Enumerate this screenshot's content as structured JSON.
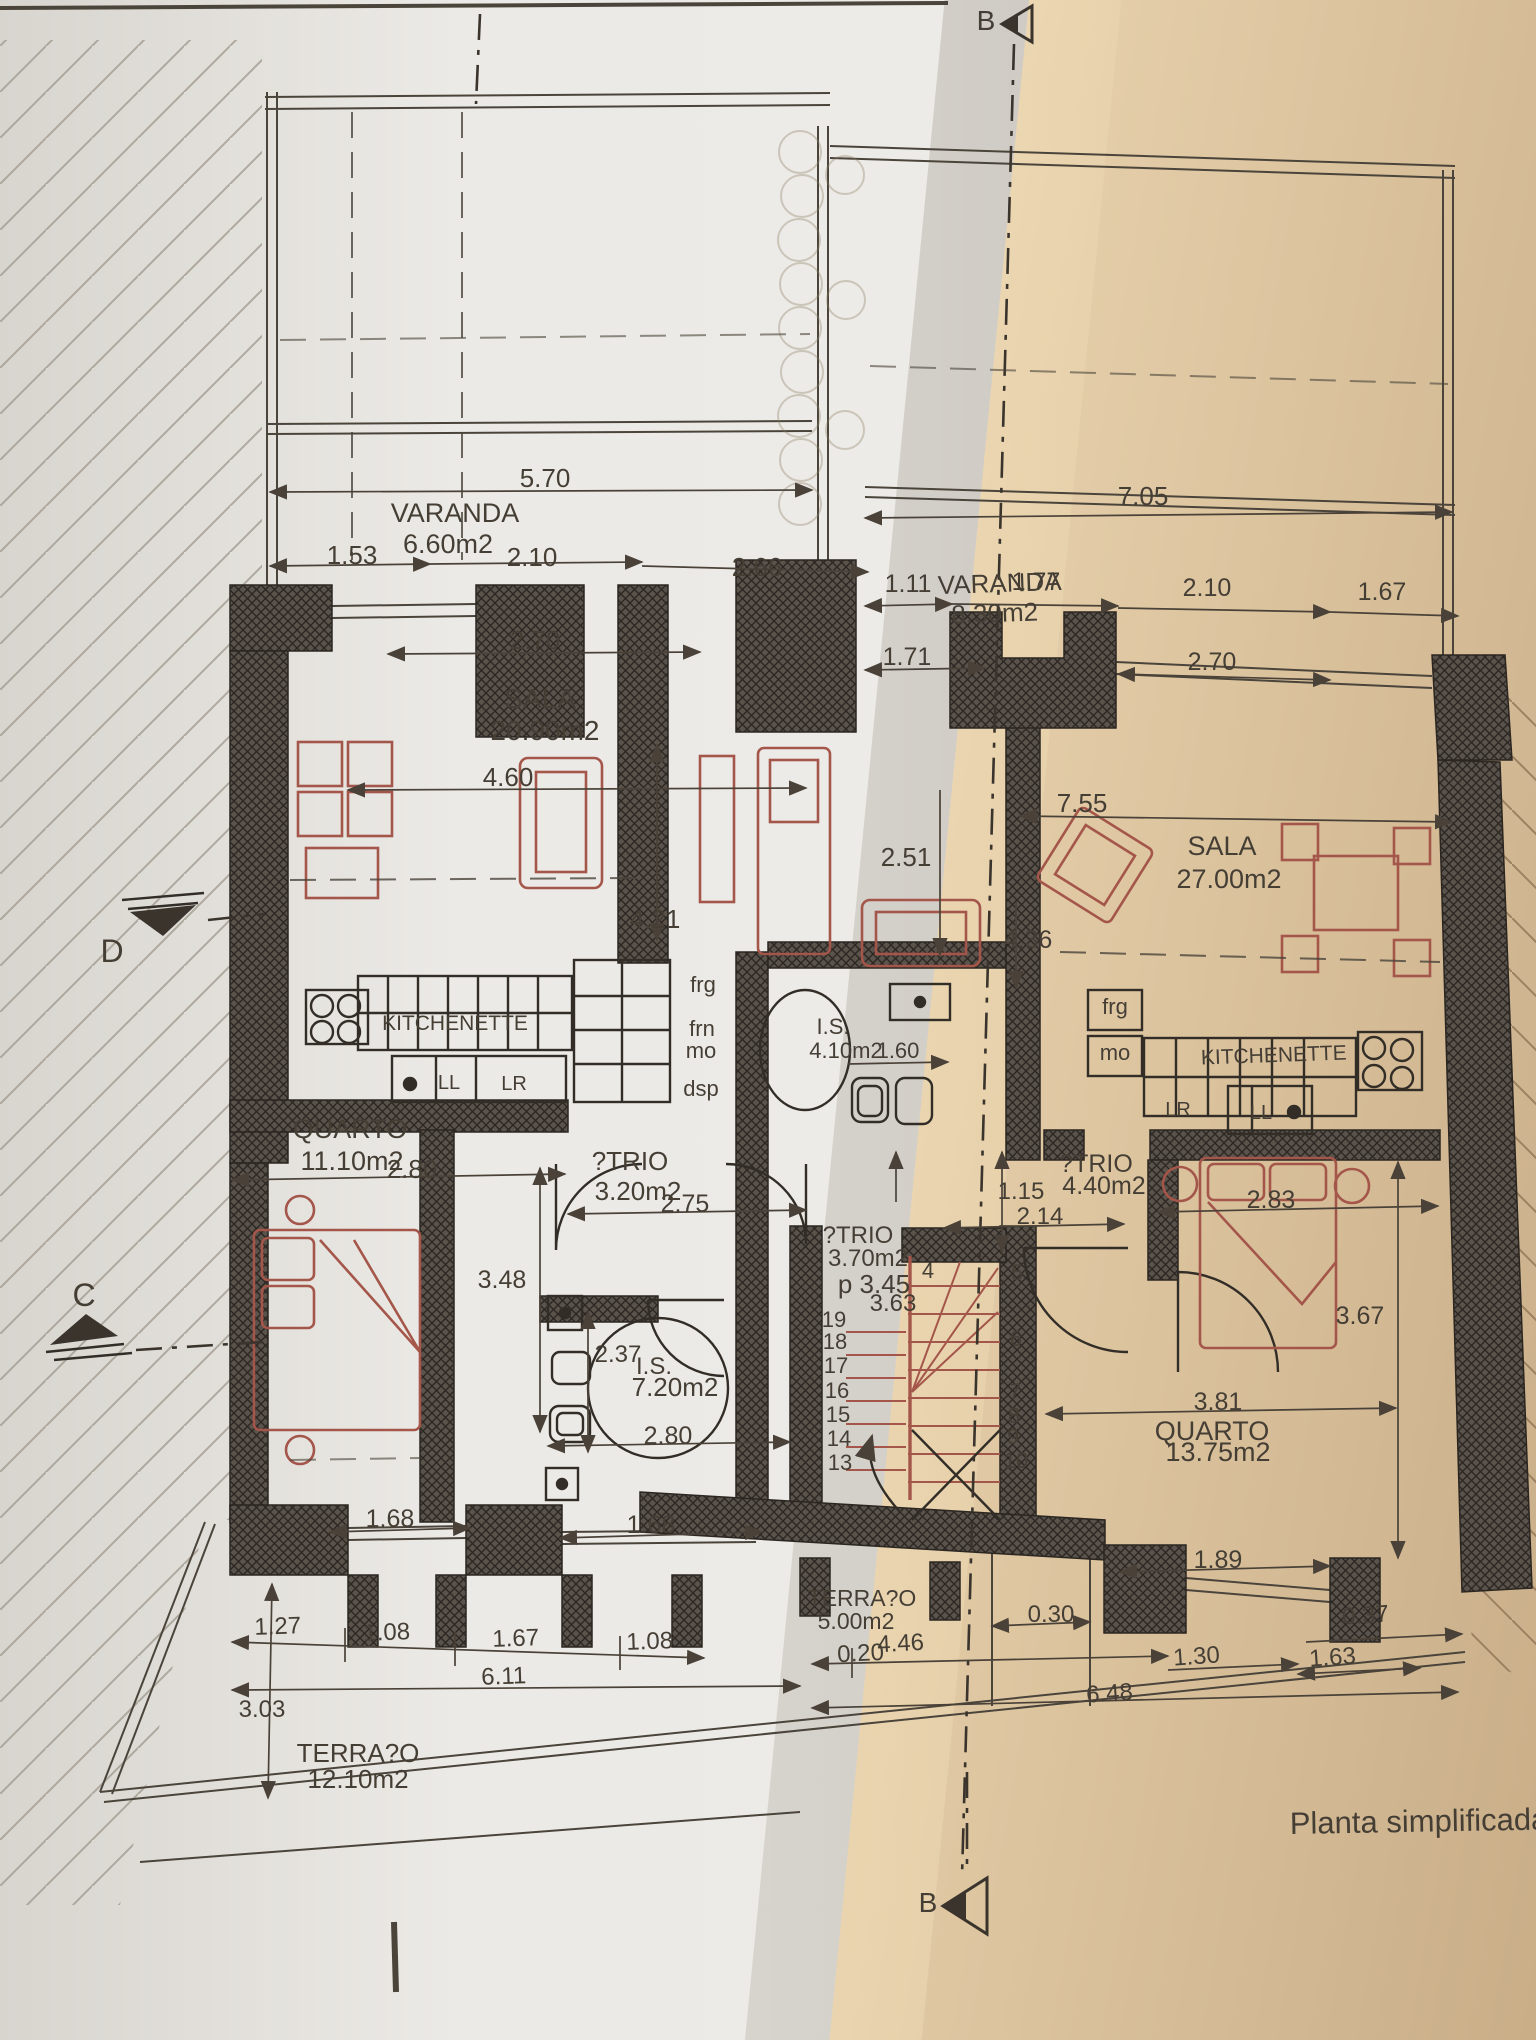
{
  "caption": "Planta simplificada d",
  "colors": {
    "paper_left": "#edebe7",
    "paper_right": "#e3cca7",
    "ink": "#453e35",
    "wall_fill": "#5a534b",
    "furniture_red": "#a4564a"
  },
  "section_markers": {
    "top": "B",
    "bottom": "B",
    "left_upper": "D",
    "left_lower": "C"
  },
  "rooms_note": "two-apartment floor plan, labels in texts[]",
  "plan": {
    "texts": [
      {
        "n": "varanda-left-label",
        "t": "VARANDA",
        "x": 455,
        "y": 522,
        "s": 27
      },
      {
        "n": "varanda-left-area",
        "t": "6.60m2",
        "x": 448,
        "y": 553,
        "s": 27
      },
      {
        "n": "dim-5-70",
        "t": "5.70",
        "x": 545,
        "y": 487,
        "s": 26
      },
      {
        "n": "dim-1-53",
        "t": "1.53",
        "x": 352,
        "y": 564,
        "s": 26
      },
      {
        "n": "dim-2-10-left",
        "t": "2.10",
        "x": 532,
        "y": 566,
        "s": 26
      },
      {
        "n": "dim-2-66",
        "t": "2.66",
        "x": 757,
        "y": 576,
        "s": 26
      },
      {
        "n": "dim-2-70-left",
        "t": "2.70",
        "x": 535,
        "y": 649,
        "s": 26
      },
      {
        "n": "dim-7-05",
        "t": "7.05",
        "x": 1143,
        "y": 505,
        "s": 26
      },
      {
        "n": "varanda-right-label",
        "t": "VARANDA",
        "x": 1000,
        "y": 592,
        "s": 26,
        "r": -2
      },
      {
        "n": "varanda-right-area",
        "t": "8.30m2",
        "x": 995,
        "y": 622,
        "s": 26,
        "r": -2
      },
      {
        "n": "dim-1-11",
        "t": "1.11",
        "x": 908,
        "y": 592,
        "s": 25
      },
      {
        "n": "dim-1-77",
        "t": "1.77",
        "x": 1036,
        "y": 590,
        "s": 25
      },
      {
        "n": "dim-2-10-right",
        "t": "2.10",
        "x": 1207,
        "y": 596,
        "s": 25
      },
      {
        "n": "dim-1-67-right",
        "t": "1.67",
        "x": 1382,
        "y": 600,
        "s": 25
      },
      {
        "n": "dim-1-71",
        "t": "1.71",
        "x": 907,
        "y": 665,
        "s": 25
      },
      {
        "n": "dim-2-70-right",
        "t": "2.70",
        "x": 1212,
        "y": 670,
        "s": 25
      },
      {
        "n": "sala-left-label",
        "t": "SALA",
        "x": 540,
        "y": 708,
        "s": 28
      },
      {
        "n": "sala-left-area",
        "t": "20.90m2",
        "x": 545,
        "y": 740,
        "s": 28
      },
      {
        "n": "dim-4-60",
        "t": "4.60",
        "x": 508,
        "y": 786,
        "s": 26
      },
      {
        "n": "dim-4-21",
        "t": "4.21",
        "x": 655,
        "y": 928,
        "s": 26
      },
      {
        "n": "dim-2-51",
        "t": "2.51",
        "x": 906,
        "y": 866,
        "s": 26
      },
      {
        "n": "dim-7-55",
        "t": "7.55",
        "x": 1082,
        "y": 812,
        "s": 26
      },
      {
        "n": "sala-right-label",
        "t": "SALA",
        "x": 1222,
        "y": 855,
        "s": 27
      },
      {
        "n": "sala-right-area",
        "t": "27.00m2",
        "x": 1229,
        "y": 888,
        "s": 27
      },
      {
        "n": "dim-4-36",
        "t": "4.36",
        "x": 1028,
        "y": 948,
        "s": 25
      },
      {
        "n": "left-frg",
        "t": "frg",
        "x": 703,
        "y": 992,
        "s": 22
      },
      {
        "n": "left-frn",
        "t": "frn",
        "x": 702,
        "y": 1036,
        "s": 22
      },
      {
        "n": "left-mo",
        "t": "mo",
        "x": 701,
        "y": 1058,
        "s": 22
      },
      {
        "n": "left-dsp",
        "t": "dsp",
        "x": 701,
        "y": 1096,
        "s": 22
      },
      {
        "n": "kitchenette-left",
        "t": "KITCHENETTE",
        "x": 455,
        "y": 1030,
        "s": 21
      },
      {
        "n": "left-ll",
        "t": "LL",
        "x": 449,
        "y": 1089,
        "s": 20
      },
      {
        "n": "left-lr",
        "t": "LR",
        "x": 514,
        "y": 1090,
        "s": 20
      },
      {
        "n": "is-mid-label",
        "t": "I.S.",
        "x": 833,
        "y": 1034,
        "s": 22
      },
      {
        "n": "is-mid-area",
        "t": "4.10m2",
        "x": 846,
        "y": 1058,
        "s": 22
      },
      {
        "n": "dim-1-60",
        "t": "1.60",
        "x": 898,
        "y": 1058,
        "s": 22
      },
      {
        "n": "right-frg",
        "t": "frg",
        "x": 1115,
        "y": 1014,
        "s": 22
      },
      {
        "n": "right-mo",
        "t": "mo",
        "x": 1115,
        "y": 1060,
        "s": 22
      },
      {
        "n": "kitchenette-right",
        "t": "KITCHENETTE",
        "x": 1274,
        "y": 1062,
        "s": 21,
        "r": -2
      },
      {
        "n": "right-lr",
        "t": "LR",
        "x": 1178,
        "y": 1116,
        "s": 20
      },
      {
        "n": "right-ll",
        "t": "LL",
        "x": 1261,
        "y": 1119,
        "s": 20
      },
      {
        "n": "quarto-left-label",
        "t": "QUARTO",
        "x": 350,
        "y": 1138,
        "s": 27
      },
      {
        "n": "quarto-left-area",
        "t": "11.10m2",
        "x": 352,
        "y": 1170,
        "s": 27
      },
      {
        "n": "dim-2-80-quarto",
        "t": "2.80",
        "x": 412,
        "y": 1178,
        "s": 26
      },
      {
        "n": "atrio-left-label",
        "t": "?TRIO",
        "x": 630,
        "y": 1170,
        "s": 26
      },
      {
        "n": "atrio-left-area",
        "t": "3.20m2",
        "x": 638,
        "y": 1200,
        "s": 26
      },
      {
        "n": "dim-2-75",
        "t": "2.75",
        "x": 685,
        "y": 1212,
        "s": 25
      },
      {
        "n": "dim-3-48",
        "t": "3.48",
        "x": 502,
        "y": 1288,
        "s": 25
      },
      {
        "n": "atrio-right-label",
        "t": "?TRIO",
        "x": 1096,
        "y": 1172,
        "s": 25
      },
      {
        "n": "atrio-right-area",
        "t": "4.40m2",
        "x": 1104,
        "y": 1194,
        "s": 25
      },
      {
        "n": "dim-1-15",
        "t": "1.15",
        "x": 1021,
        "y": 1199,
        "s": 24
      },
      {
        "n": "dim-2-14",
        "t": "2.14",
        "x": 1040,
        "y": 1224,
        "s": 24
      },
      {
        "n": "atrio-mid-label",
        "t": "?TRIO",
        "x": 858,
        "y": 1243,
        "s": 24
      },
      {
        "n": "atrio-mid-area",
        "t": "3.70m2",
        "x": 868,
        "y": 1266,
        "s": 24
      },
      {
        "n": "dim-3-45",
        "t": "p 3.45",
        "x": 874,
        "y": 1293,
        "s": 26
      },
      {
        "n": "dim-3-63",
        "t": "3.63",
        "x": 893,
        "y": 1311,
        "s": 24
      },
      {
        "n": "stair-num-19",
        "t": "19",
        "x": 834,
        "y": 1327,
        "s": 22
      },
      {
        "n": "stair-num-18",
        "t": "18",
        "x": 835,
        "y": 1349,
        "s": 22
      },
      {
        "n": "stair-num-17",
        "t": "17",
        "x": 836,
        "y": 1373,
        "s": 22
      },
      {
        "n": "stair-num-16",
        "t": "16",
        "x": 837,
        "y": 1398,
        "s": 22
      },
      {
        "n": "stair-num-15",
        "t": "15",
        "x": 838,
        "y": 1422,
        "s": 22
      },
      {
        "n": "stair-num-14",
        "t": "14",
        "x": 839,
        "y": 1446,
        "s": 22
      },
      {
        "n": "stair-num-13",
        "t": "13",
        "x": 840,
        "y": 1470,
        "s": 22
      },
      {
        "n": "stair-num-4",
        "t": "4",
        "x": 928,
        "y": 1278,
        "s": 22
      },
      {
        "n": "stair-num-5",
        "t": "5",
        "x": 1017,
        "y": 1280,
        "s": 22
      },
      {
        "n": "stair-num-6",
        "t": "6",
        "x": 1016,
        "y": 1346,
        "s": 22
      },
      {
        "n": "stair-num-7",
        "t": "7",
        "x": 1015,
        "y": 1399,
        "s": 22
      },
      {
        "n": "stair-num-8",
        "t": "8",
        "x": 1014,
        "y": 1423,
        "s": 22
      },
      {
        "n": "stair-num-9",
        "t": "9",
        "x": 1013,
        "y": 1444,
        "s": 22
      },
      {
        "n": "stair-num-10",
        "t": "10",
        "x": 1016,
        "y": 1468,
        "s": 22
      },
      {
        "n": "dim-2-37",
        "t": "2.37",
        "x": 618,
        "y": 1362,
        "s": 24
      },
      {
        "n": "is-left-label",
        "t": "I.S.",
        "x": 654,
        "y": 1374,
        "s": 24
      },
      {
        "n": "is-left-area",
        "t": "7.20m2",
        "x": 675,
        "y": 1396,
        "s": 26
      },
      {
        "n": "dim-2-80-is",
        "t": "2.80",
        "x": 668,
        "y": 1444,
        "s": 25
      },
      {
        "n": "dim-2-83",
        "t": "2.83",
        "x": 1271,
        "y": 1208,
        "s": 25
      },
      {
        "n": "dim-3-67",
        "t": "3.67",
        "x": 1360,
        "y": 1324,
        "s": 25
      },
      {
        "n": "dim-3-81",
        "t": "3.81",
        "x": 1218,
        "y": 1410,
        "s": 25
      },
      {
        "n": "quarto-right-label",
        "t": "QUARTO",
        "x": 1212,
        "y": 1440,
        "s": 27
      },
      {
        "n": "quarto-right-area",
        "t": "13.75m2",
        "x": 1218,
        "y": 1461,
        "s": 27
      },
      {
        "n": "dim-1-89",
        "t": "1.89",
        "x": 1218,
        "y": 1568,
        "s": 25
      },
      {
        "n": "dim-1-68-left",
        "t": "1.68",
        "x": 390,
        "y": 1527,
        "s": 25
      },
      {
        "n": "dim-1-68-mid",
        "t": "1.68",
        "x": 651,
        "y": 1533,
        "s": 25
      },
      {
        "n": "terraco-mid-label",
        "t": "TERRA?O",
        "x": 862,
        "y": 1606,
        "s": 23
      },
      {
        "n": "terraco-mid-area",
        "t": "5.00m2",
        "x": 856,
        "y": 1629,
        "s": 23
      },
      {
        "n": "dim-0-30",
        "t": "0.30",
        "x": 1051,
        "y": 1622,
        "s": 24
      },
      {
        "n": "dim-0-20",
        "t": "0.20",
        "x": 861,
        "y": 1661,
        "s": 24,
        "r": -3
      },
      {
        "n": "dim-4-46",
        "t": "4.46",
        "x": 901,
        "y": 1651,
        "s": 24,
        "r": -3
      },
      {
        "n": "dim-1-30",
        "t": "1.30",
        "x": 1197,
        "y": 1664,
        "s": 24,
        "r": -4
      },
      {
        "n": "dim-6-48",
        "t": "6.48",
        "x": 1110,
        "y": 1701,
        "s": 24,
        "r": -4
      },
      {
        "n": "dim-0-37",
        "t": "0.37",
        "x": 1366,
        "y": 1623,
        "s": 24,
        "r": -4
      },
      {
        "n": "dim-1-63",
        "t": "1.63",
        "x": 1333,
        "y": 1665,
        "s": 24,
        "r": -4
      },
      {
        "n": "dim-1-27",
        "t": "1.27",
        "x": 278,
        "y": 1634,
        "s": 24,
        "r": -2
      },
      {
        "n": "dim-1-08-a",
        "t": "1.08",
        "x": 387,
        "y": 1640,
        "s": 24,
        "r": -2
      },
      {
        "n": "dim-1-67-bottom",
        "t": "1.67",
        "x": 516,
        "y": 1646,
        "s": 24,
        "r": -2
      },
      {
        "n": "dim-1-08-b",
        "t": "1.08",
        "x": 650,
        "y": 1649,
        "s": 24,
        "r": -2
      },
      {
        "n": "dim-6-11",
        "t": "6.11",
        "x": 504,
        "y": 1684,
        "s": 24,
        "r": -2
      },
      {
        "n": "dim-3-03",
        "t": "3.03",
        "x": 262,
        "y": 1717,
        "s": 24
      },
      {
        "n": "terraco-left-label",
        "t": "TERRA?O",
        "x": 358,
        "y": 1762,
        "s": 26
      },
      {
        "n": "terraco-left-area",
        "t": "12.10m2",
        "x": 358,
        "y": 1788,
        "s": 26
      },
      {
        "n": "marker-d-label",
        "t": "D",
        "x": 112,
        "y": 962,
        "s": 32
      },
      {
        "n": "marker-c-label",
        "t": "C",
        "x": 84,
        "y": 1306,
        "s": 32
      },
      {
        "n": "marker-b-top-label",
        "t": "B",
        "x": 986,
        "y": 30,
        "s": 28
      },
      {
        "n": "marker-b-bottom-label",
        "t": "B",
        "x": 928,
        "y": 1912,
        "s": 28
      },
      {
        "n": "plan-caption",
        "t": "Planta simplificada d",
        "x": 1290,
        "y": 1834,
        "s": 31,
        "a": "start",
        "r": -1
      }
    ]
  }
}
